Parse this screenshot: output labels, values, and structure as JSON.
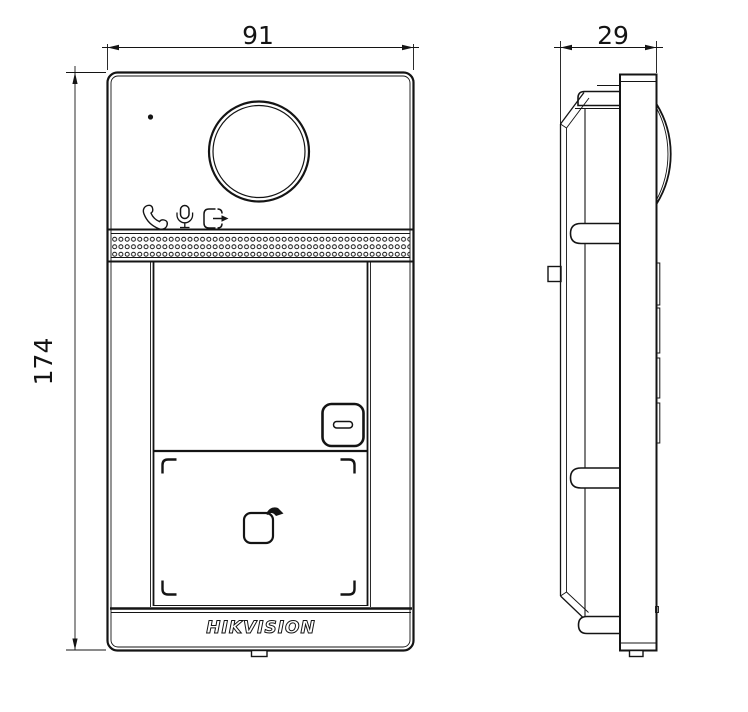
{
  "drawing_type": "intercom-door-station-dimension-drawing",
  "colors": {
    "line": "#141414",
    "background": "#ffffff"
  },
  "dimensions": {
    "front_width": "91",
    "front_height": "174",
    "side_depth": "29"
  },
  "branding": {
    "logo_text": "HIKVISION"
  },
  "icons": {
    "call": "call-icon",
    "microphone": "microphone-icon",
    "door_release": "door-release-icon",
    "card_swipe": "card-swipe-icon"
  }
}
